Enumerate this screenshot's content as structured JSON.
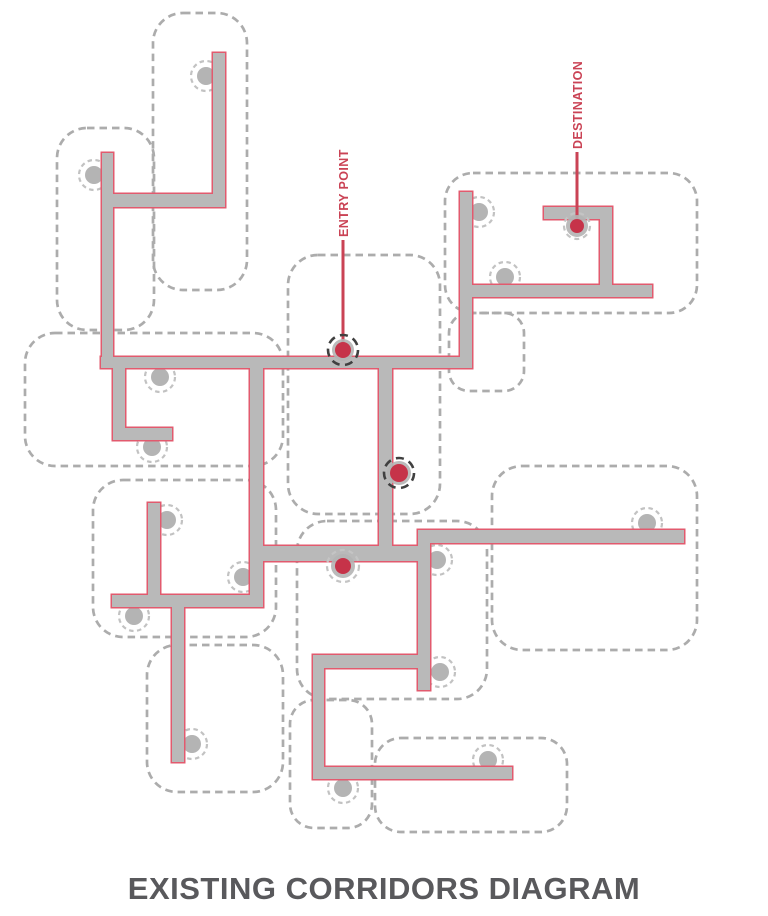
{
  "title": "EXISTING CORRIDORS DIAGRAM",
  "labels": {
    "entry": {
      "text": "ENTRY POINT",
      "anchor_x": 348,
      "anchor_y": 237,
      "line": {
        "x": 343,
        "y1": 240,
        "y2": 350
      }
    },
    "destination": {
      "text": "DESTINATION",
      "anchor_x": 582,
      "anchor_y": 149,
      "line": {
        "x": 577,
        "y1": 152,
        "y2": 226
      }
    }
  },
  "colors": {
    "background": "#ffffff",
    "corridor_fill": "#b9b9b9",
    "corridor_outline": "#e25a6e",
    "room_border": "#acacac",
    "gray_dot": "#b4b4b4",
    "gray_ring": "#c2c2c2",
    "connector_red": "#ca4355",
    "red_dot": "#c63349",
    "ring_dark": "#404040",
    "ring_light": "#c4c4c4",
    "title_color": "#59595c"
  },
  "rooms": [
    {
      "x": 153,
      "y": 13,
      "w": 94,
      "h": 277,
      "r": 30
    },
    {
      "x": 57,
      "y": 128,
      "w": 97,
      "h": 202,
      "r": 30
    },
    {
      "x": 25,
      "y": 333,
      "w": 258,
      "h": 133,
      "r": 30
    },
    {
      "x": 93,
      "y": 480,
      "w": 183,
      "h": 157,
      "r": 30
    },
    {
      "x": 147,
      "y": 645,
      "w": 136,
      "h": 147,
      "r": 30
    },
    {
      "x": 288,
      "y": 255,
      "w": 152,
      "h": 259,
      "r": 30
    },
    {
      "x": 297,
      "y": 521,
      "w": 190,
      "h": 178,
      "r": 30
    },
    {
      "x": 290,
      "y": 700,
      "w": 82,
      "h": 128,
      "r": 24
    },
    {
      "x": 375,
      "y": 738,
      "w": 192,
      "h": 94,
      "r": 26
    },
    {
      "x": 449,
      "y": 313,
      "w": 75,
      "h": 78,
      "r": 20
    },
    {
      "x": 445,
      "y": 173,
      "w": 252,
      "h": 140,
      "r": 28
    },
    {
      "x": 492,
      "y": 466,
      "w": 205,
      "h": 184,
      "r": 30
    }
  ],
  "corridors": [
    {
      "x": 102,
      "y": 153,
      "w": 11,
      "h": 215
    },
    {
      "x": 102,
      "y": 194,
      "w": 123,
      "h": 13
    },
    {
      "x": 213,
      "y": 53,
      "w": 12,
      "h": 154
    },
    {
      "x": 101,
      "y": 357,
      "w": 371,
      "h": 11
    },
    {
      "x": 113,
      "y": 368,
      "w": 12,
      "h": 72
    },
    {
      "x": 113,
      "y": 428,
      "w": 59,
      "h": 12
    },
    {
      "x": 250,
      "y": 368,
      "w": 13,
      "h": 239
    },
    {
      "x": 112,
      "y": 595,
      "w": 151,
      "h": 12
    },
    {
      "x": 148,
      "y": 503,
      "w": 12,
      "h": 104
    },
    {
      "x": 172,
      "y": 607,
      "w": 12,
      "h": 155
    },
    {
      "x": 379,
      "y": 368,
      "w": 13,
      "h": 193
    },
    {
      "x": 263,
      "y": 546,
      "w": 167,
      "h": 15
    },
    {
      "x": 418,
      "y": 530,
      "w": 12,
      "h": 160
    },
    {
      "x": 418,
      "y": 530,
      "w": 266,
      "h": 13
    },
    {
      "x": 313,
      "y": 655,
      "w": 117,
      "h": 13
    },
    {
      "x": 313,
      "y": 655,
      "w": 11,
      "h": 124
    },
    {
      "x": 313,
      "y": 767,
      "w": 199,
      "h": 12
    },
    {
      "x": 460,
      "y": 192,
      "w": 12,
      "h": 176
    },
    {
      "x": 460,
      "y": 285,
      "w": 192,
      "h": 12
    },
    {
      "x": 600,
      "y": 207,
      "w": 12,
      "h": 90
    },
    {
      "x": 544,
      "y": 207,
      "w": 68,
      "h": 12
    }
  ],
  "gray_dots": [
    {
      "cx": 206,
      "cy": 76
    },
    {
      "cx": 94,
      "cy": 175
    },
    {
      "cx": 160,
      "cy": 377
    },
    {
      "cx": 152,
      "cy": 447
    },
    {
      "cx": 167,
      "cy": 520
    },
    {
      "cx": 243,
      "cy": 577
    },
    {
      "cx": 134,
      "cy": 616
    },
    {
      "cx": 192,
      "cy": 744
    },
    {
      "cx": 479,
      "cy": 212
    },
    {
      "cx": 505,
      "cy": 277
    },
    {
      "cx": 647,
      "cy": 523
    },
    {
      "cx": 437,
      "cy": 560
    },
    {
      "cx": 440,
      "cy": 672
    },
    {
      "cx": 488,
      "cy": 760
    },
    {
      "cx": 343,
      "cy": 788
    }
  ],
  "red_markers": [
    {
      "name": "entry-point-dot",
      "cx": 343,
      "cy": 350,
      "r": 8,
      "halo": 11,
      "ring_r": 15,
      "ring": "dark"
    },
    {
      "name": "waypoint-dot-upper",
      "cx": 399,
      "cy": 473,
      "r": 9,
      "halo": 12,
      "ring_r": 15,
      "ring": "dark"
    },
    {
      "name": "waypoint-dot-lower",
      "cx": 343,
      "cy": 566,
      "r": 8,
      "halo": 12,
      "ring_r": 16,
      "ring": "light"
    },
    {
      "name": "destination-dot",
      "cx": 577,
      "cy": 226,
      "r": 7,
      "halo": 11,
      "ring_r": 13,
      "ring": "light"
    }
  ]
}
